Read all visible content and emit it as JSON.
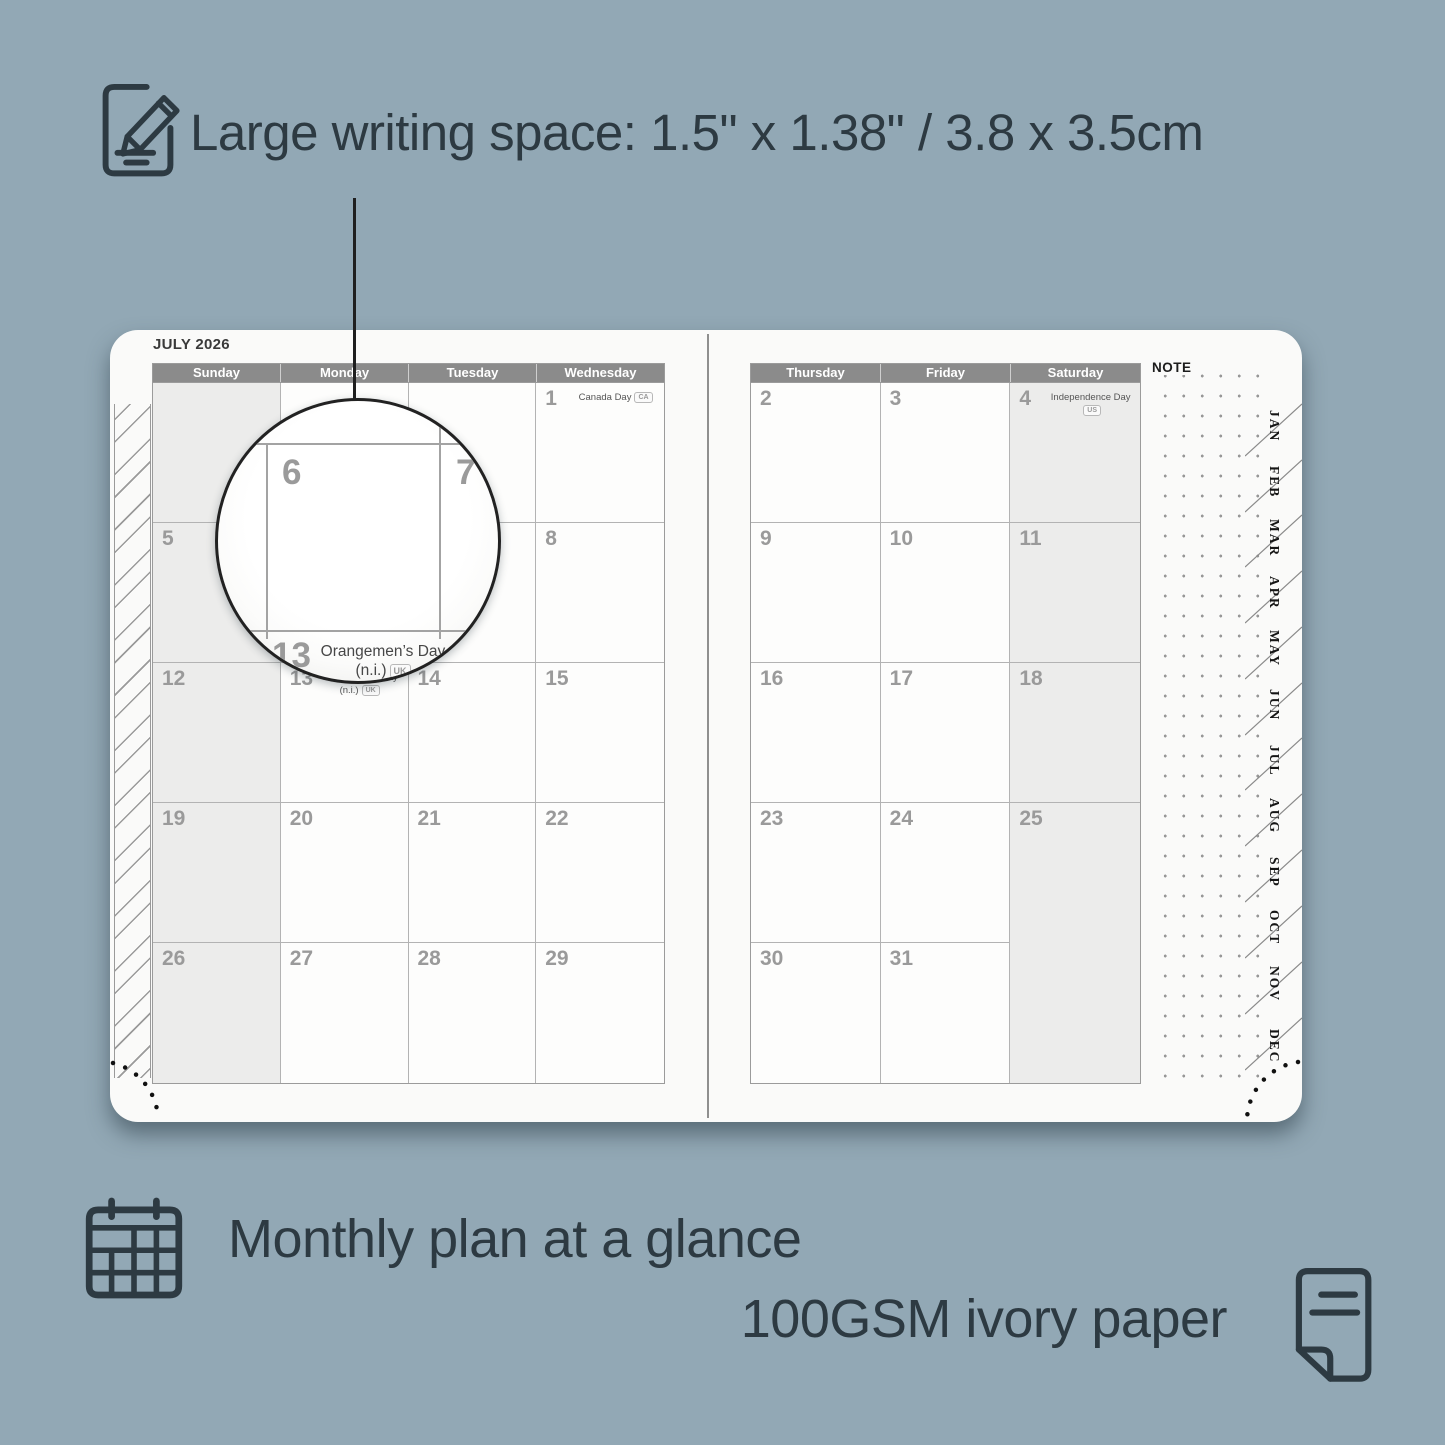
{
  "colors": {
    "background": "#92a8b5",
    "ink": "#2d3a42",
    "header_bar": "#8b8b8b",
    "shaded_cell": "#ececeb",
    "page": "#fafaf9"
  },
  "icons": {
    "top": "notepad-pencil",
    "monthly": "calendar-grid",
    "paper": "paper-sheet"
  },
  "callouts": {
    "writing_space": "Large writing space: 1.5\" x 1.38\" / 3.8 x 3.5cm",
    "monthly_plan": "Monthly plan at a glance",
    "paper": "100GSM ivory paper"
  },
  "planner": {
    "month_title": "JULY 2026",
    "note_label": "NOTE",
    "left_day_headers": [
      "Sunday",
      "Monday",
      "Tuesday",
      "Wednesday"
    ],
    "right_day_headers": [
      "Thursday",
      "Friday",
      "Saturday"
    ],
    "left_cells": [
      {
        "date": ""
      },
      {
        "date": ""
      },
      {
        "date": ""
      },
      {
        "date": "1",
        "h1": "Canada Day",
        "b1": "CA"
      },
      {
        "date": "5"
      },
      {
        "date": "6"
      },
      {
        "date": "7"
      },
      {
        "date": "8"
      },
      {
        "date": "12"
      },
      {
        "date": "13",
        "h1": "Orangemen’s Day",
        "h2": "(n.i.)",
        "b2": "UK"
      },
      {
        "date": "14"
      },
      {
        "date": "15"
      },
      {
        "date": "19"
      },
      {
        "date": "20"
      },
      {
        "date": "21"
      },
      {
        "date": "22"
      },
      {
        "date": "26"
      },
      {
        "date": "27"
      },
      {
        "date": "28"
      },
      {
        "date": "29"
      }
    ],
    "right_cells": [
      {
        "date": "2"
      },
      {
        "date": "3"
      },
      {
        "date": "4",
        "h1": "Independence Day",
        "b1": "US"
      },
      {
        "date": "9"
      },
      {
        "date": "10"
      },
      {
        "date": "11"
      },
      {
        "date": "16"
      },
      {
        "date": "17"
      },
      {
        "date": "18"
      },
      {
        "date": "23"
      },
      {
        "date": "24"
      },
      {
        "date": "25"
      },
      {
        "date": "30"
      },
      {
        "date": "31"
      },
      {
        "date": ""
      }
    ],
    "month_tabs": [
      "JAN",
      "FEB",
      "MAR",
      "APR",
      "MAY",
      "JUN",
      "JUL",
      "AUG",
      "SEP",
      "OCT",
      "NOV",
      "DEC"
    ],
    "magnifier": {
      "date_left": "6",
      "date_right": "7",
      "date_bottom": "13",
      "holiday_line1": "Orangemen’s Day",
      "holiday_line2": "(n.i.)",
      "badge": "UK"
    }
  }
}
